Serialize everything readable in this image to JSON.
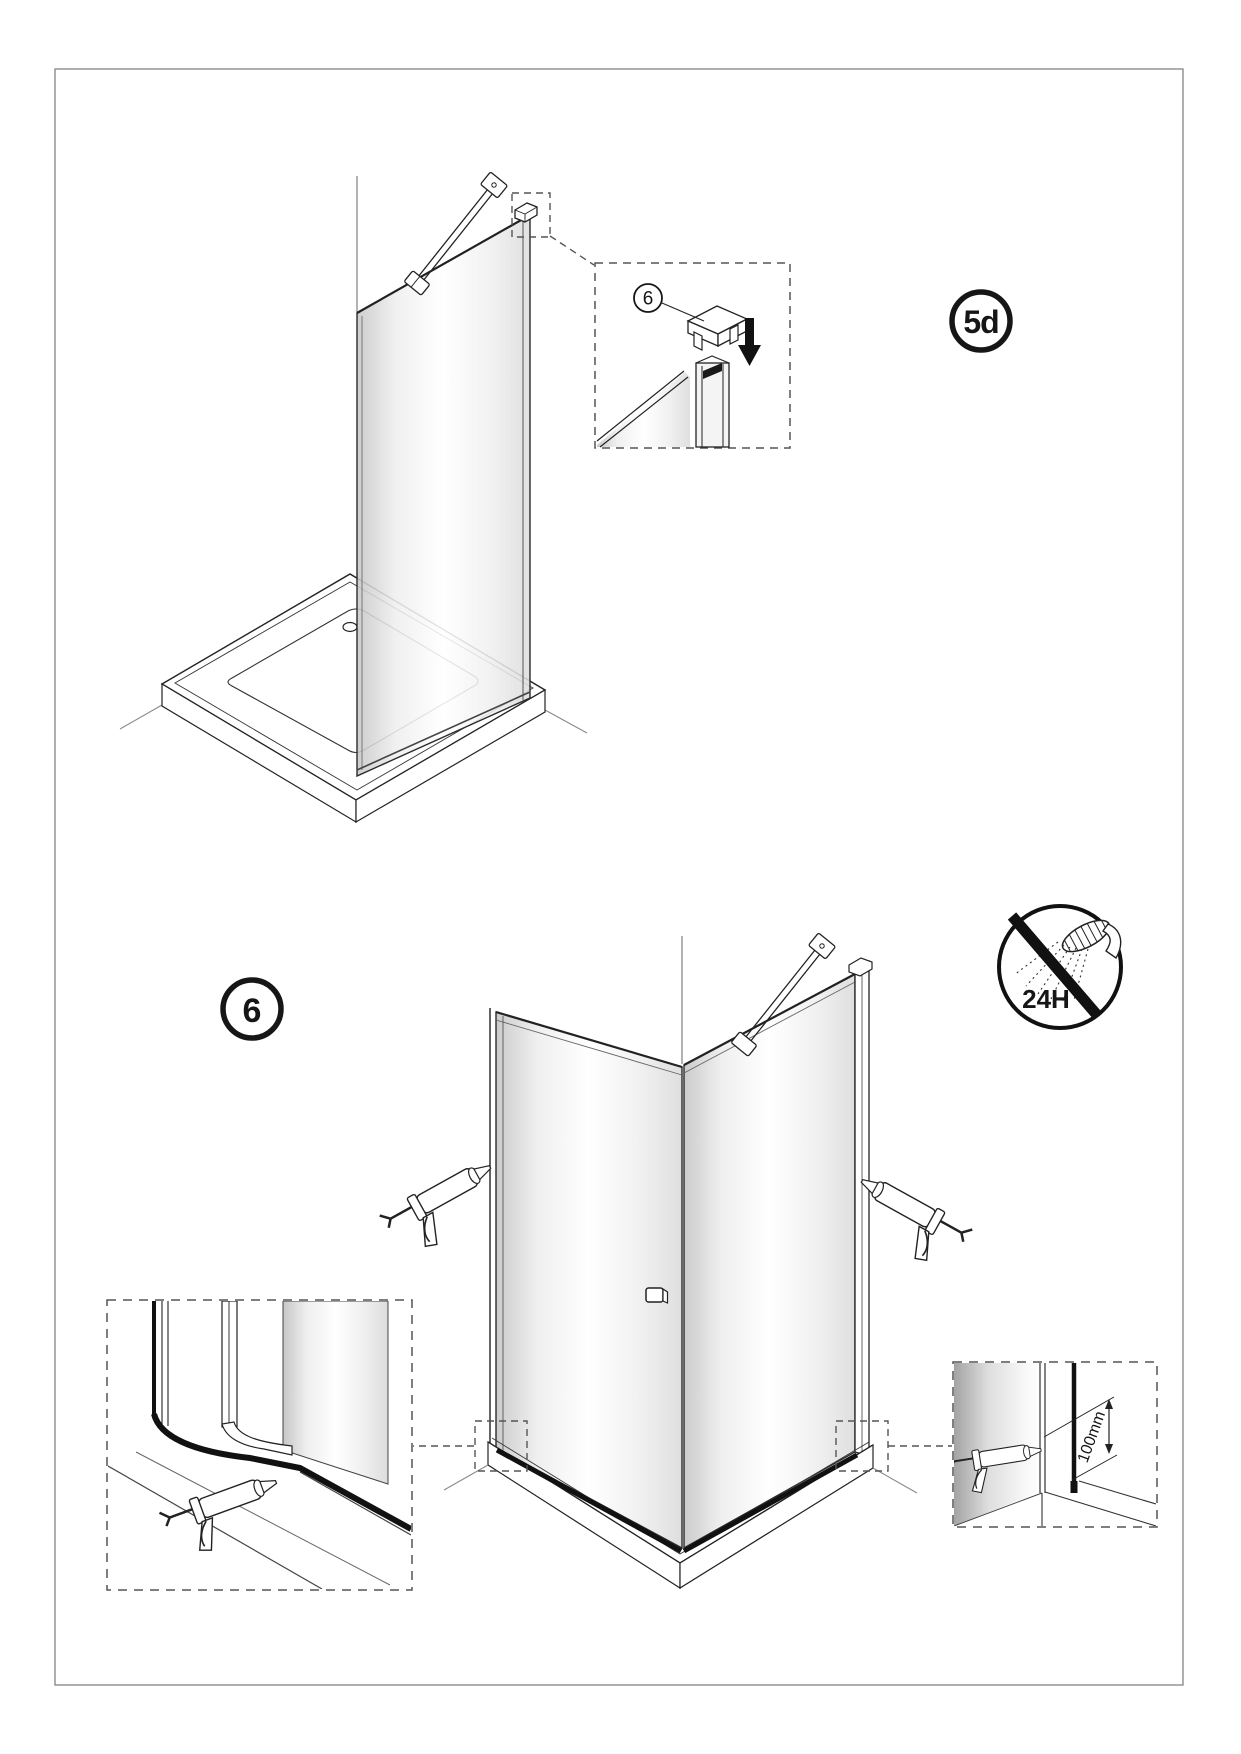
{
  "page": {
    "background": "#ffffff",
    "frame_color": "#7a7a7a",
    "line_color": "#222222",
    "sealant_color": "#111111"
  },
  "steps": {
    "current": {
      "label": "5d"
    },
    "next": {
      "label": "6"
    }
  },
  "callouts": {
    "cap_part_number": "6"
  },
  "warnings": {
    "no_shower_wait_label": "24H"
  },
  "dimensions": {
    "sealant_height_label": "100mm"
  }
}
